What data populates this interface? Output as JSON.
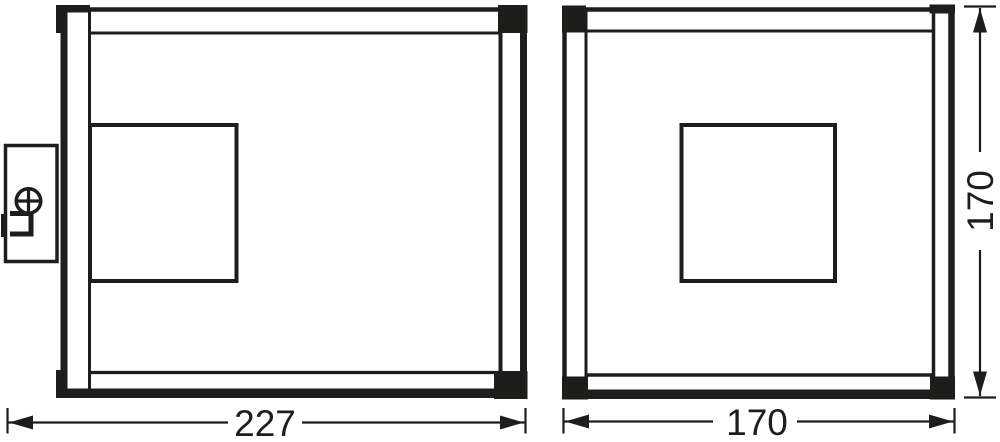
{
  "colors": {
    "line": "#1d1d1b",
    "background": "#ffffff"
  },
  "dimensions": {
    "side_view_width": "227",
    "front_view_width": "170",
    "front_view_height": "170"
  }
}
